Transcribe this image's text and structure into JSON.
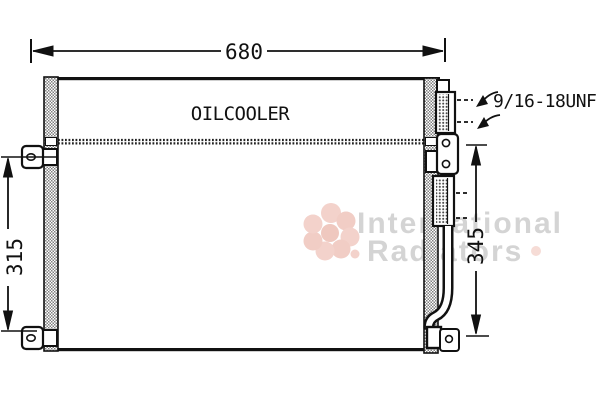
{
  "drawing": {
    "part_label": "OILCOOLER",
    "fitting_label": "9/16-18UNF",
    "dimensions": {
      "width": "680",
      "height_left": "315",
      "height_right": "345"
    },
    "watermark": {
      "line1": "International",
      "line2": "Radiators"
    },
    "colors": {
      "line": "#111111",
      "hatch_gray": "#808080",
      "watermark_text": "#d4d4d4",
      "logo_pink": "#f3d2cb",
      "background": "#ffffff"
    }
  }
}
